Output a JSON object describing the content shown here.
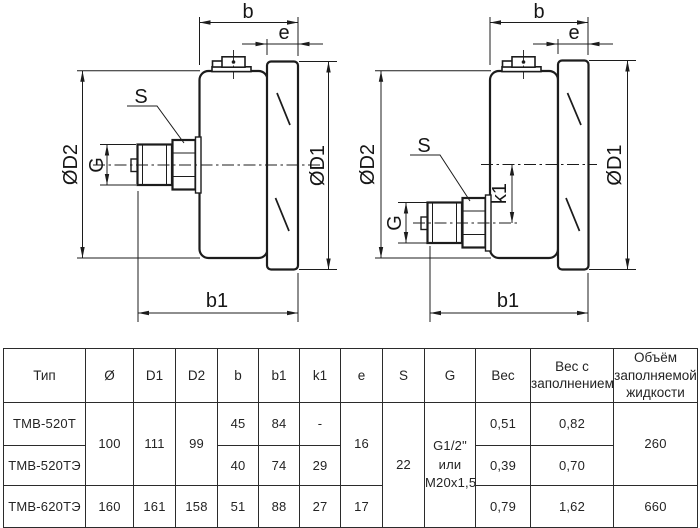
{
  "drawing": {
    "left_view": {
      "dim_b": "b",
      "dim_e": "e",
      "dim_s": "S",
      "dim_g": "G",
      "dim_d2": "ØD2",
      "dim_d1": "ØD1",
      "dim_b1": "b1"
    },
    "right_view": {
      "dim_b": "b",
      "dim_e": "e",
      "dim_s": "S",
      "dim_g": "G",
      "dim_d2": "ØD2",
      "dim_d1": "ØD1",
      "dim_k1": "k1",
      "dim_b1": "b1"
    }
  },
  "table": {
    "headers": [
      "Тип",
      "Ø",
      "D1",
      "D2",
      "b",
      "b1",
      "k1",
      "e",
      "S",
      "G",
      "Вес",
      "Вес с заполнением",
      "Объём заполняемой жидкости"
    ],
    "rows": [
      {
        "type": "ТМВ-520Т",
        "diameter": "100",
        "d1": "111",
        "d2": "99",
        "b": "45",
        "b1": "84",
        "k1": "-",
        "e": "16",
        "s": "22",
        "g": "G1/2\"\nили\nM20x1,5",
        "weight": "0,51",
        "weight_filled": "0,82",
        "volume": "260"
      },
      {
        "type": "ТМВ-520ТЭ",
        "b": "40",
        "b1": "74",
        "k1": "29",
        "weight": "0,39",
        "weight_filled": "0,70"
      },
      {
        "type": "ТМВ-620ТЭ",
        "diameter": "160",
        "d1": "161",
        "d2": "158",
        "b": "51",
        "b1": "88",
        "k1": "27",
        "e": "17",
        "weight": "0,79",
        "weight_filled": "1,62",
        "volume": "660"
      }
    ]
  }
}
